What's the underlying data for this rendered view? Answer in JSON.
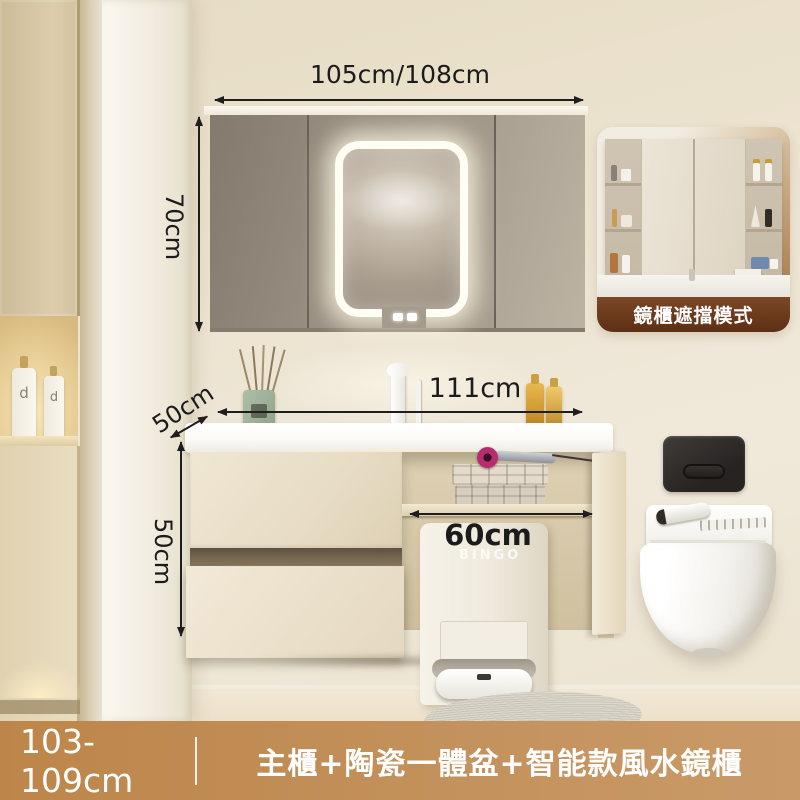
{
  "annotations": {
    "mirror_cabinet_width": "105cm/108cm",
    "mirror_cabinet_height": "70cm",
    "countertop_depth": "50cm",
    "countertop_width": "111cm",
    "cabinet_height": "50cm",
    "open_section_width": "60cm"
  },
  "inset_card": {
    "caption": "鏡櫃遮擋模式"
  },
  "bottom_bar": {
    "size_range": "103-109cm",
    "product_title": "主櫃+陶瓷一體盆+智能款風水鏡櫃"
  },
  "labels": {
    "dock_watermark": "BINGO",
    "niche_bottle_letter": "d"
  },
  "colors": {
    "annotation_text": "#1b1b1b",
    "bottom_bar_bg": "#c08c54",
    "bottom_bar_text": "#ffffff",
    "inset_caption_bg": "#6e3c1f",
    "inset_caption_text": "#ffffff",
    "led_glow": "#fffdf4",
    "hairdryer_accent": "#b52d6e",
    "wall": "#ece3d0",
    "mirror_cabinet": "#a89d8e"
  }
}
